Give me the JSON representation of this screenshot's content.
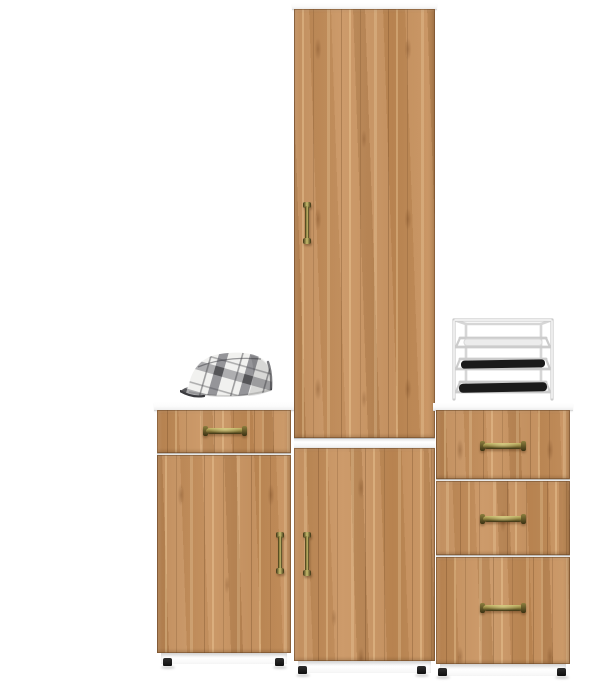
{
  "scene": {
    "type": "product-photo",
    "subject": "Three-piece oak hallway furniture set on a white background",
    "text_content": "none"
  },
  "palette": {
    "bg": "#ffffff",
    "wood_base": "#c68d56",
    "wood_light": "#e0b57d",
    "wood_dark": "#8f6236",
    "slab_edge": "#d8d8d8",
    "brass_dark": "#3a3112",
    "brass_mid": "#8d7f3e",
    "brass_light": "#c9bd6e",
    "foot_black": "#1f1f1f",
    "hat_base": "#f1f1ef",
    "hat_stripe": "#77777c",
    "hat_stripe_dark": "#4c4c50",
    "hat_shadow": "#3a3a3e",
    "rack_line": "#cccccc",
    "rack_fill": "#f8f8f8",
    "shoe_black": "#1b1b1b"
  },
  "furniture": {
    "left_cabinet": {
      "label": "low cabinet with one drawer and one door",
      "drawer_count": 1,
      "door_count": 1,
      "handle_style": "antique brass"
    },
    "tall_cabinet": {
      "label": "tall wardrobe column with upper and lower doors, white top and middle trim",
      "door_count": 2,
      "handle_style": "antique brass"
    },
    "right_cabinet": {
      "label": "chest of three drawers",
      "drawer_count": 3,
      "handle_style": "antique brass"
    }
  },
  "props": {
    "cap": {
      "label": "grey plaid flat cap on left cabinet top"
    },
    "shoe_rack": {
      "label": "white wire shoe rack with dark shoes on right cabinet top",
      "tray_count": 3
    }
  }
}
